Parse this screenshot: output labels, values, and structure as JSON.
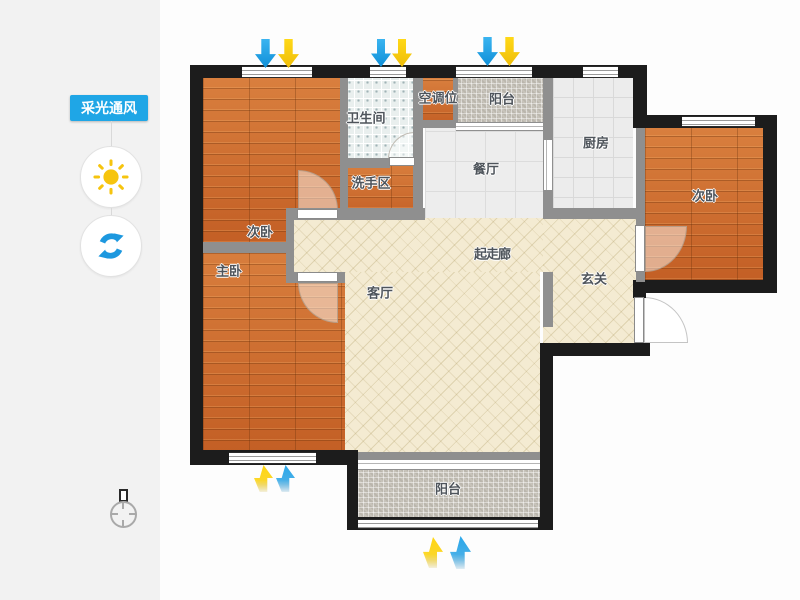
{
  "sidebar": {
    "tool_label": "采光通风",
    "icons": {
      "sun_icon": "sun",
      "rotate_icon": "rotate-refresh",
      "compass_icon": "north-compass",
      "wind_down_icon": "arrow-down",
      "wind_up_icon": "arrow-up"
    }
  },
  "floorplan": {
    "rooms": [
      {
        "id": "bedroom-second-left",
        "label": "次卧"
      },
      {
        "id": "bedroom-master",
        "label": "主卧"
      },
      {
        "id": "bathroom",
        "label": "卫生间"
      },
      {
        "id": "wash-area",
        "label": "洗手区"
      },
      {
        "id": "ac-spot",
        "label": "空调位"
      },
      {
        "id": "balcony-top",
        "label": "阳台"
      },
      {
        "id": "dining-room",
        "label": "餐厅"
      },
      {
        "id": "kitchen",
        "label": "厨房"
      },
      {
        "id": "bedroom-second-right",
        "label": "次卧"
      },
      {
        "id": "corridor",
        "label": "起走廊"
      },
      {
        "id": "foyer",
        "label": "玄关"
      },
      {
        "id": "living-room",
        "label": "客厅"
      },
      {
        "id": "balcony-bottom",
        "label": "阳台"
      }
    ],
    "colors": {
      "wall_exterior": "#1c1c1c",
      "wall_interior": "#8f8f8f",
      "wood_floor": "#cc6c30",
      "hatch_floor": "#f4ebd2",
      "bath_tile": "#e9efee",
      "kitchen_tile": "#ececec",
      "balcony_mosaic": "#c7c3ba",
      "accent_blue": "#1fa6e6",
      "arrow_blue": "#2aa7ea",
      "arrow_yellow": "#ffd613"
    }
  }
}
